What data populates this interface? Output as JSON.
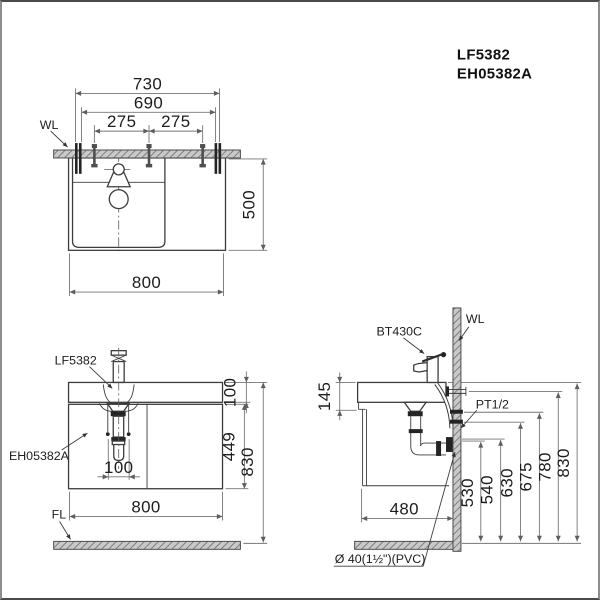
{
  "title": {
    "model_faucet": "LF5382",
    "model_cabinet": "EH05382A"
  },
  "labels": {
    "wall_top": "WL",
    "wall_side": "WL",
    "floor": "FL",
    "faucet_front": "LF5382",
    "cabinet_front": "EH05382A",
    "faucet_side": "BT430C",
    "supply": "PT1/2",
    "drain_pipe": "Ø 40(1½\")(PVC)"
  },
  "dims_top": {
    "d730": "730",
    "d690": "690",
    "d275L": "275",
    "d275R": "275",
    "d500": "500",
    "d800": "800"
  },
  "dims_front": {
    "d100_counter": "100",
    "d449": "449",
    "d830": "830",
    "d100_drain": "100",
    "d800": "800"
  },
  "dims_side": {
    "d145": "145",
    "d480": "480",
    "d530": "530",
    "d540": "540",
    "d630": "630",
    "d675": "675",
    "d780": "780",
    "d830": "830"
  },
  "colors": {
    "line": "#3c3c3c",
    "dimension": "#757575",
    "text": "#1c1c1c",
    "hatch_background": "#c9c9c9",
    "hatch_stroke": "#6b6b6b",
    "background": "#ffffff",
    "border": "#8d8d8d"
  }
}
